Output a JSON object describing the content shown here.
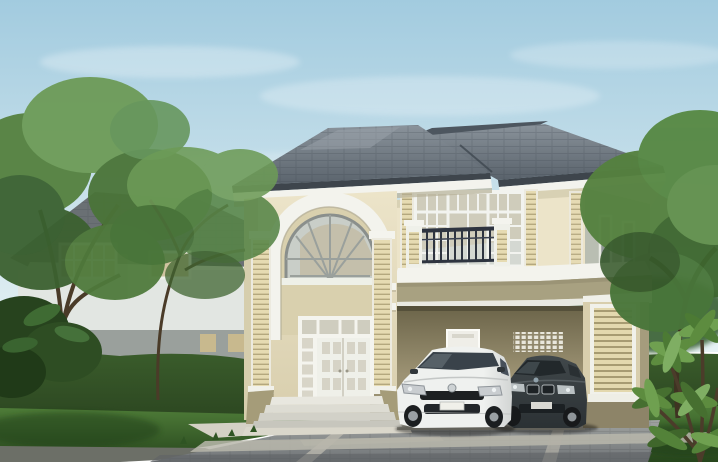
{
  "scene": {
    "type": "architectural-rendering",
    "subject": "two-story detached house with arched portico, balcony and carport",
    "foreground": "white hatchback car and dark sedan parked on paver driveway",
    "background": "neighboring house, hedge, lawn and trees under a clear sky"
  },
  "palette": {
    "sky_top": "#a2cbdf",
    "sky_bottom": "#e7f2f4",
    "cloud": "#ffffff",
    "roof_light": "#8a939b",
    "roof_deep": "#59626b",
    "roof_back": "#4d565f",
    "gutter_dark": "#3e454c",
    "trim_white": "#f3f3ed",
    "wall_cream": "#ece4c9",
    "wall_cream_dark": "#d8cead",
    "wall_side": "#b9beb2",
    "band_olive": "#a8a181",
    "pilaster": "#e6dbb2",
    "pilaster_stripe": "#b4a87e",
    "glass": "#d4d8d2",
    "glass_dark": "#39424a",
    "railing": "#2e3440",
    "carport_wall": "#9c9273",
    "carport_dark": "#6b6449",
    "neighbor_wall": "#e2e6e2",
    "neighbor_roof": "#6a7074",
    "hedge": "#3a5c2b",
    "hedge_dark": "#2b4520",
    "lawn": "#4e7c38",
    "lawn_dark": "#27461d",
    "tree_green": "#55813f",
    "tree_light": "#6d9b57",
    "tree_dark": "#3c6130",
    "trunk": "#48392a",
    "driveway": "#a0a3a1",
    "driveway_dark": "#6f7376",
    "paver_band": "#bcbab0",
    "walkway": "#d4d1c5",
    "car_white": "#eff1ef",
    "car_white_shade": "#d2d5d4",
    "car_dark": "#41484b",
    "car_dark_deep": "#2b3134"
  }
}
